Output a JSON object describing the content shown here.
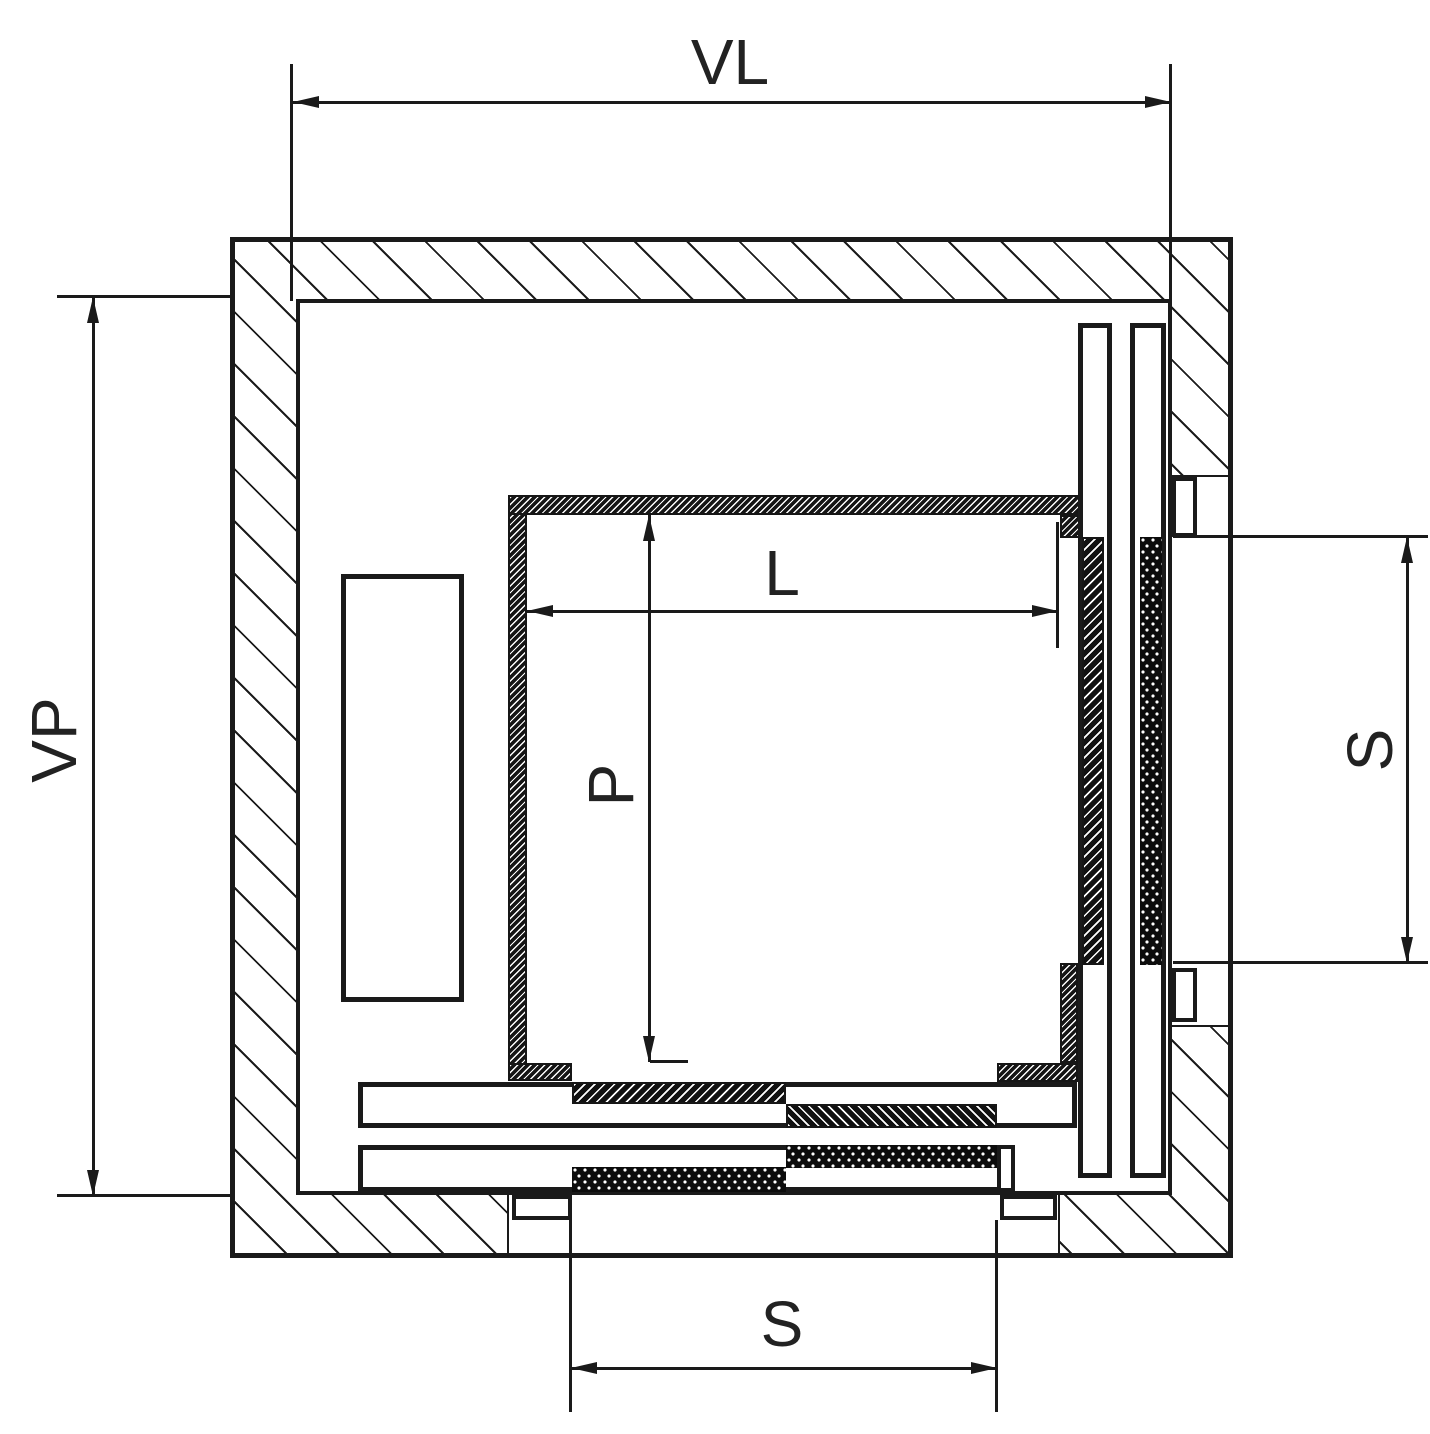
{
  "drawing": {
    "kind": "elevator-shaft-plan-section",
    "colors": {
      "line": "#1a1a1a",
      "background": "#ffffff"
    },
    "dimension_labels": {
      "shaft_width": "VL",
      "shaft_depth": "VP",
      "car_interior_width": "L",
      "car_interior_depth": "P",
      "side_door_opening": "S",
      "front_door_opening": "S"
    }
  }
}
